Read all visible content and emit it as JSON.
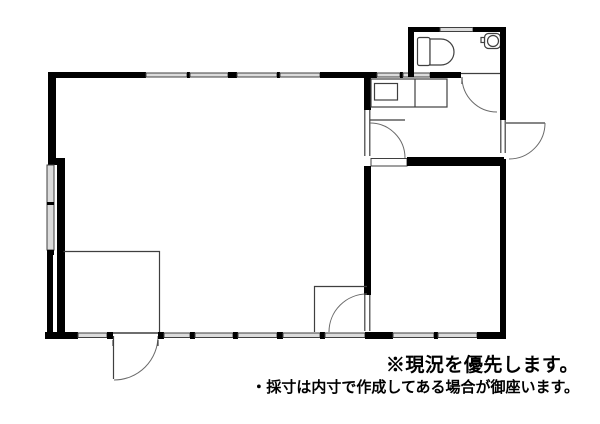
{
  "canvas": {
    "width": 600,
    "height": 424,
    "background": "#ffffff"
  },
  "colors": {
    "wall": "#000000",
    "thin_line": "#3f3f3f",
    "window_fill": "#dcdcdc",
    "door_arc": "#6a6a6a",
    "text": "#000000"
  },
  "icons": {
    "toilet": "toilet-icon",
    "toilet_tank": "toilet-tank-icon",
    "hand_wash_basin": "hand-wash-basin-icon",
    "kitchen_counter": "kitchen-counter-icon",
    "kitchen_sink": "kitchen-sink-icon",
    "door_swing": "door-swing-arc-icon",
    "window": "window-symbol",
    "closet": "closet-outline"
  },
  "notes": {
    "line1": "※現況を優先します。",
    "line2": "・採寸は内寸で作成してある場合が御座います。"
  }
}
